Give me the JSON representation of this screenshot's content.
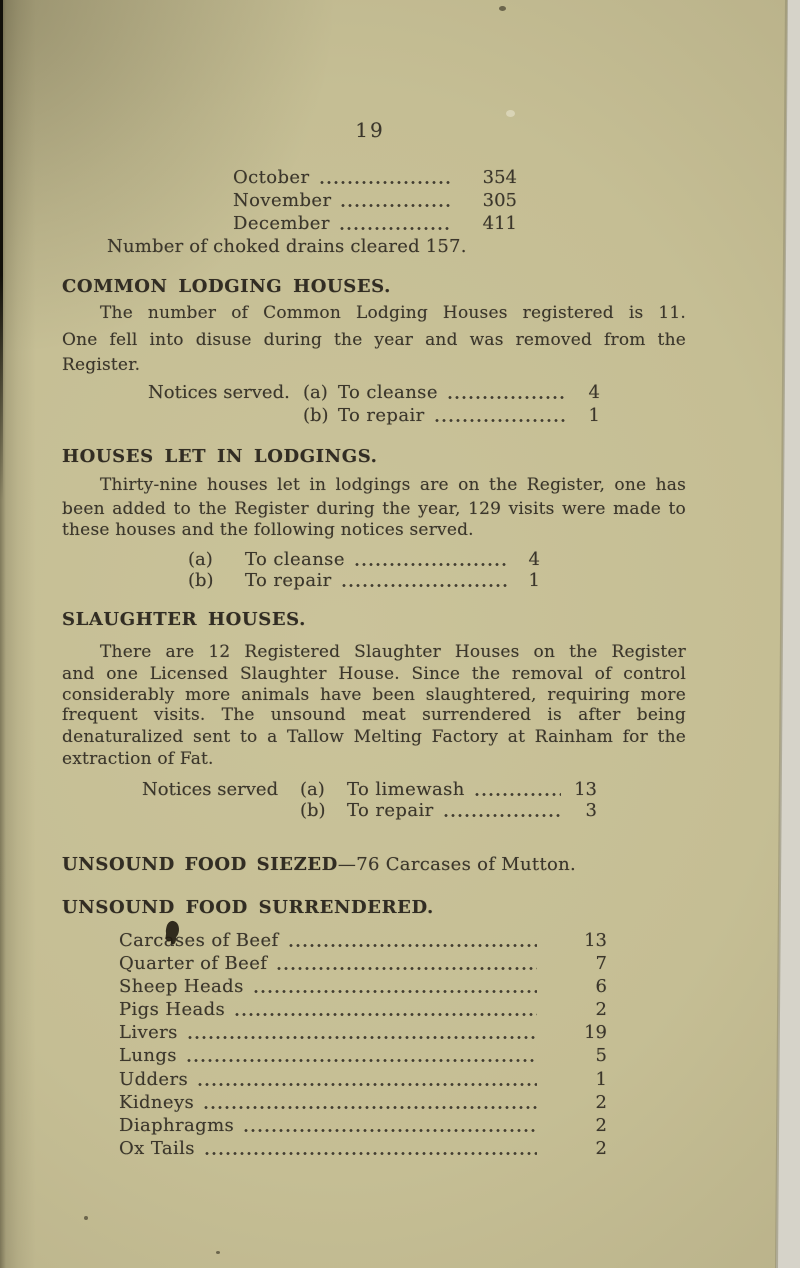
{
  "page": {
    "number": "19"
  },
  "colors": {
    "paper": "#c5be94",
    "paper_shadow": "#a69e79",
    "ink": "#3b362b",
    "page_edge_strip": "#d6d3c9"
  },
  "months": {
    "rows": [
      {
        "label": "October",
        "value": "354"
      },
      {
        "label": "November",
        "value": "305"
      },
      {
        "label": "December",
        "value": "411"
      }
    ]
  },
  "drains": {
    "line": "Number of choked drains cleared 157."
  },
  "sections": {
    "common": {
      "heading": "COMMON LODGING HOUSES.",
      "lines": [
        "The number of Common Lodging Houses registered is 11.",
        "One fell into disuse during the year and was removed from the",
        "Register."
      ],
      "notices_prefix": "Notices served.",
      "notices": [
        {
          "tag": "(a)",
          "label": "To cleanse",
          "value": "4"
        },
        {
          "tag": "(b)",
          "label": "To repair",
          "value": "1"
        }
      ]
    },
    "lodgings": {
      "heading": "HOUSES LET IN LODGINGS.",
      "lines": [
        "Thirty-nine houses let in lodgings are on the Register, one has",
        "been added to the Register during the year, 129 visits were made to",
        "these houses and the following notices served."
      ],
      "notices": [
        {
          "tag": "(a)",
          "label": "To cleanse",
          "value": "4"
        },
        {
          "tag": "(b)",
          "label": "To repair",
          "value": "1"
        }
      ]
    },
    "slaughter": {
      "heading": "SLAUGHTER HOUSES.",
      "lines": [
        "There are 12 Registered Slaughter Houses on the Register",
        "and one Licensed Slaughter House.  Since the removal of control",
        "considerably more animals have been slaughtered, requiring more",
        "frequent visits.  The unsound meat surrendered is after being",
        "denaturalized sent to a Tallow Melting Factory at Rainham for the",
        "extraction of Fat."
      ],
      "notices_prefix": "Notices served",
      "notices": [
        {
          "tag": "(a)",
          "label": "To limewash",
          "value": "13"
        },
        {
          "tag": "(b)",
          "label": "To repair",
          "value": "3"
        }
      ]
    },
    "seized": {
      "heading_bold": "UNSOUND FOOD SIEZED",
      "heading_rest": "—76 Carcases of Mutton."
    },
    "surrendered": {
      "heading": "UNSOUND FOOD SURRENDERED.",
      "items": [
        {
          "label": "Carcases of Beef",
          "value": "13"
        },
        {
          "label": "Quarter of Beef",
          "value": "7"
        },
        {
          "label": "Sheep Heads",
          "value": "6"
        },
        {
          "label": "Pigs Heads",
          "value": "2"
        },
        {
          "label": "Livers",
          "value": "19"
        },
        {
          "label": "Lungs",
          "value": "5"
        },
        {
          "label": "Udders",
          "value": "1"
        },
        {
          "label": "Kidneys",
          "value": "2"
        },
        {
          "label": "Diaphragms",
          "value": "2"
        },
        {
          "label": "Ox Tails",
          "value": "2"
        }
      ]
    }
  }
}
